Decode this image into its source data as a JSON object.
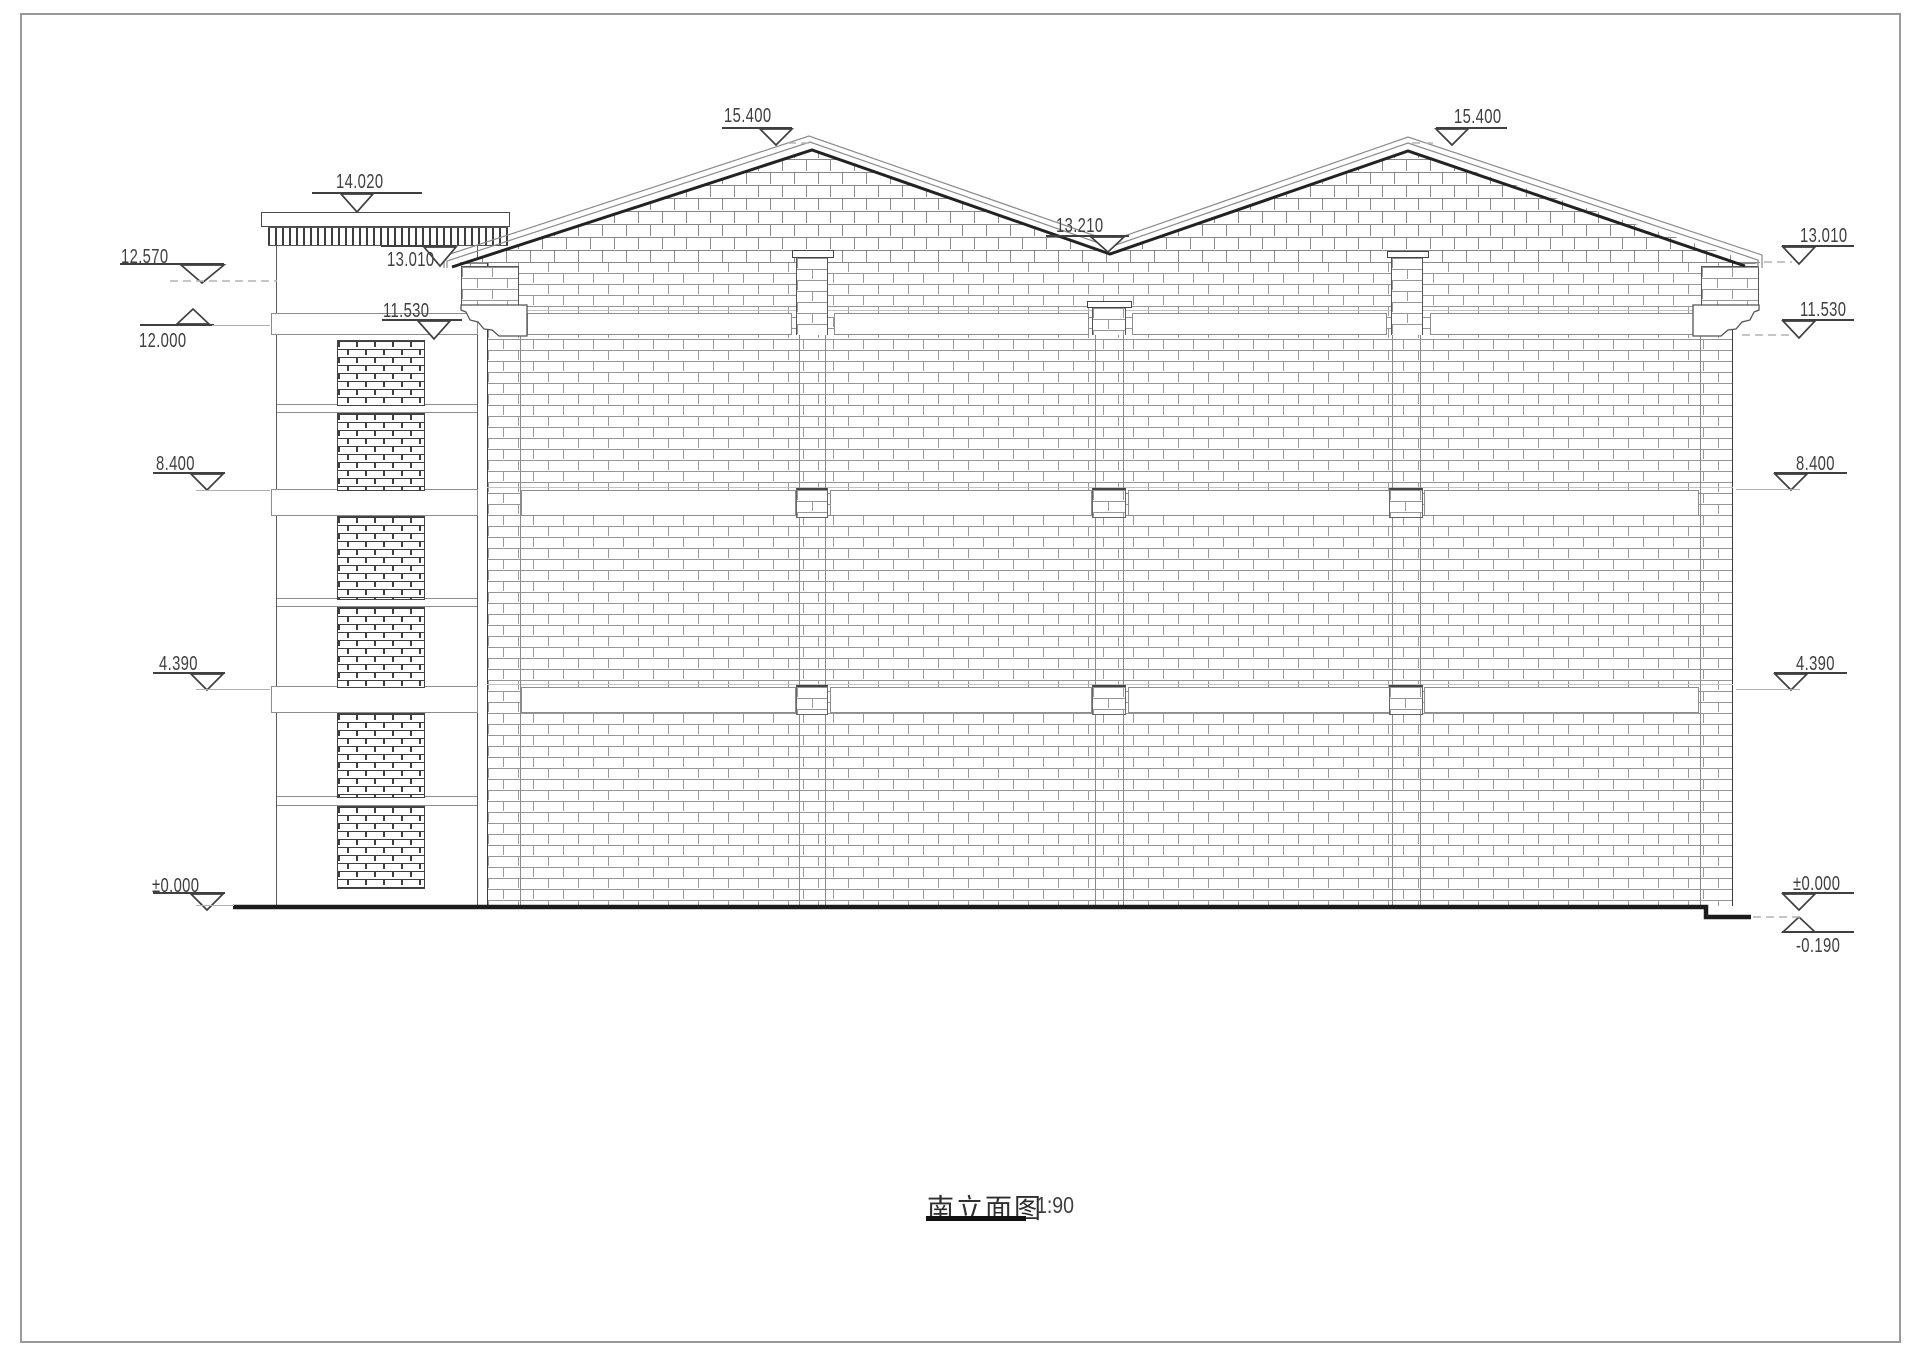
{
  "sheet": {
    "title": "南立面图",
    "scale_label": "1:90"
  },
  "elevations": {
    "left": {
      "v12_570": "12.570",
      "v12_000": "12.000",
      "v8_400": "8.400",
      "v4_390": "4.390",
      "v0_000": "±0.000"
    },
    "tower": {
      "v14_020": "14.020",
      "v13_010": "13.010",
      "v11_530": "11.530"
    },
    "roof": {
      "left_peak": "15.400",
      "valley": "13.210",
      "right_peak": "15.400"
    },
    "right": {
      "v13_010": "13.010",
      "v11_530": "11.530",
      "v8_400": "8.400",
      "v4_390": "4.390",
      "v0_000": "±0.000",
      "v_minus_0_190": "-0.190"
    }
  },
  "colors": {
    "dim_line": "#3f3f3f",
    "thin_line": "#8a8a8a",
    "thick_line": "#1f1f1f",
    "brick_line": "#969696"
  }
}
